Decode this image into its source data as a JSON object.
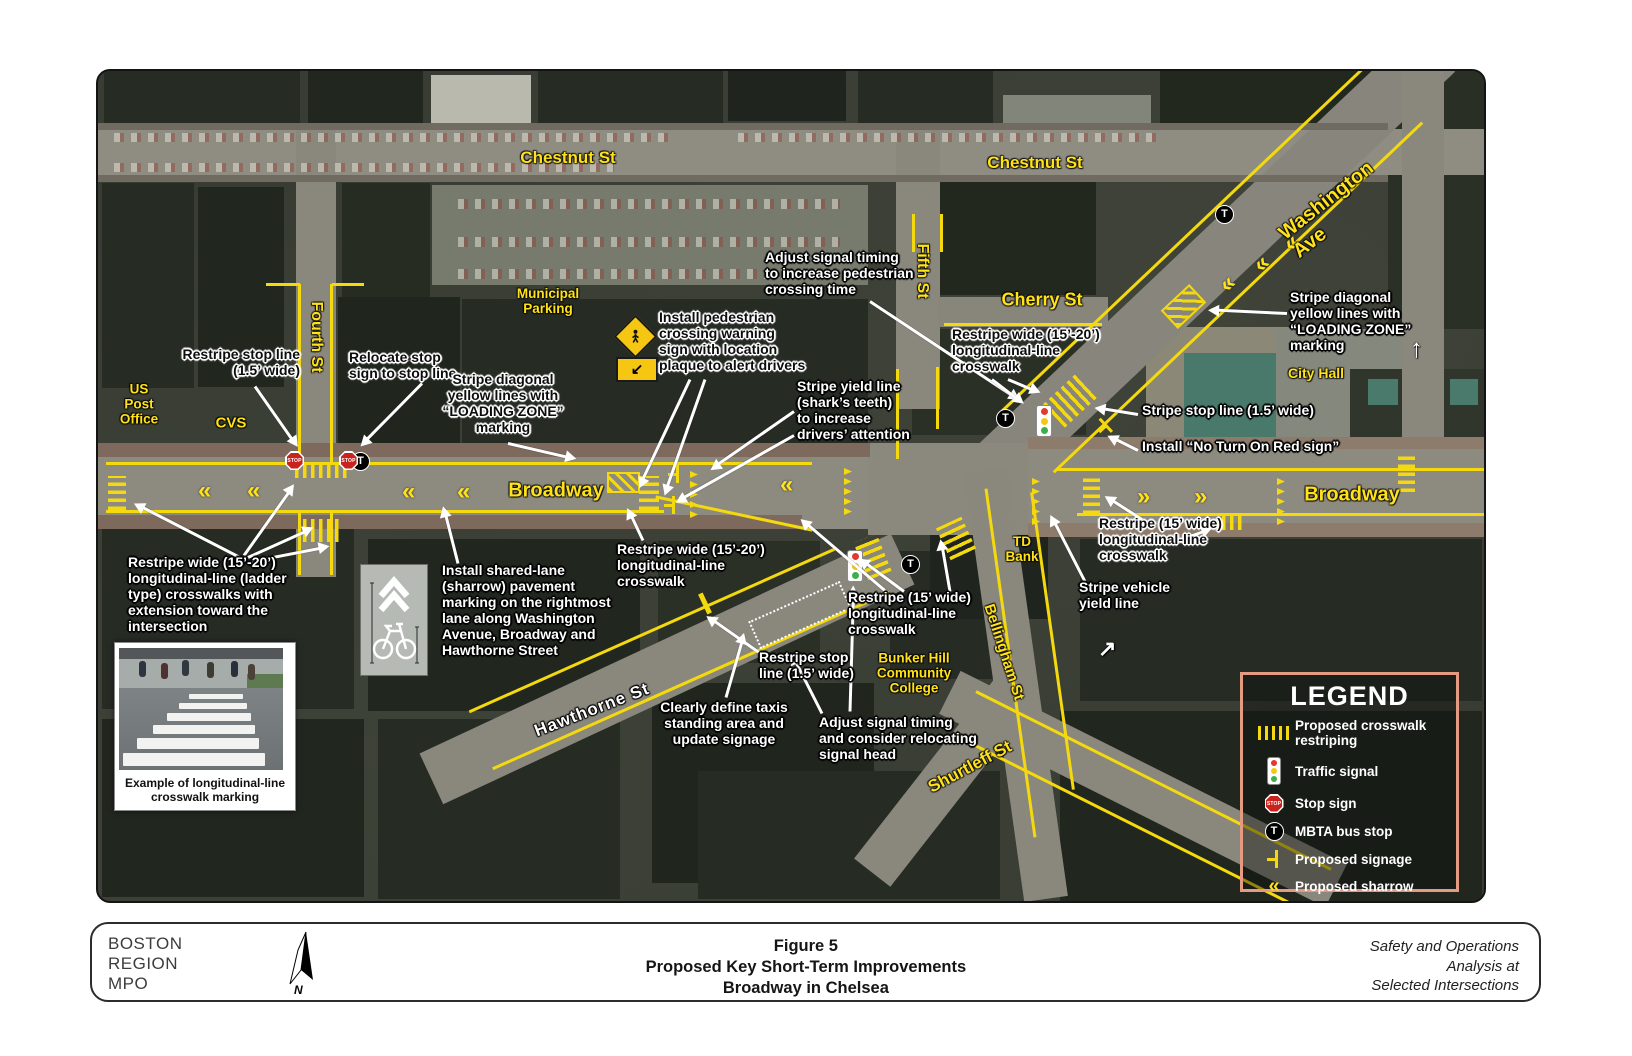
{
  "map": {
    "streets": {
      "chestnut_west": "Chestnut St",
      "chestnut_east": "Chestnut St",
      "fourth": "Fourth St",
      "fifth": "Fifth St",
      "cherry": "Cherry St",
      "washington": "Washington Ave",
      "broadway_west": "Broadway",
      "broadway_east": "Broadway",
      "hawthorne": "Hawthorne St",
      "bellingham": "Bellingham St",
      "shurtleff": "Shurtleff St"
    },
    "places": {
      "municipal_parking": "Municipal\nParking",
      "us_post_office": "US\nPost\nOffice",
      "cvs": "CVS",
      "city_hall": "City Hall",
      "td_bank": "TD\nBank",
      "bunker_hill": "Bunker Hill\nCommunity\nCollege"
    },
    "callouts": {
      "restripe_stop_nw": "Restripe stop line\n(1.5’ wide)",
      "relocate_stop": "Relocate stop\nsign to stop line",
      "loading_zone_w": "Stripe diagonal\nyellow lines with\n“LOADING ZONE”\nmarking",
      "ped_sign": "Install pedestrian\ncrossing warning\nsign with location\nplaque to alert drivers",
      "adjust_signal_n": "Adjust signal timing\nto increase pedestrian\ncrossing time",
      "yield_line": "Stripe yield line\n(shark’s teeth)\nto increase\ndrivers’ attention",
      "restripe_cherry": "Restripe wide (15’-20’)\nlongitudinal-line\ncrosswalk",
      "loading_zone_e": "Stripe diagonal\nyellow lines with\n“LOADING ZONE”\nmarking",
      "stop_line_e": "Stripe stop line (1.5’ wide)",
      "no_turn_red": "Install “No Turn On Red sign”",
      "restripe_15_e": "Restripe (15’ wide)\nlongitudinal-line\ncrosswalk",
      "vehicle_yield": "Stripe vehicle\nyield line",
      "restripe_15_c": "Restripe (15’ wide)\nlongitudinal-line\ncrosswalk",
      "ladder": "Restripe wide (15’-20’)\nlongitudinal-line (ladder\ntype) crosswalks with\nextension toward the\nintersection",
      "sharrow_note": "Install shared-lane\n(sharrow) pavement\nmarking on the rightmost\nlane along Washington\nAvenue, Broadway and\nHawthorne Street",
      "restripe_wide_c": "Restripe wide (15’-20’)\nlongitudinal-line\ncrosswalk",
      "restripe_stop_s": "Restripe stop\nline (1.5’ wide)",
      "taxi": "Clearly define taxis\nstanding area and\nupdate signage",
      "adjust_signal_s": "Adjust signal timing\nand consider relocating\nsignal head"
    },
    "inset_photo_caption": "Example of longitudinal-line\ncrosswalk marking"
  },
  "legend": {
    "title": "LEGEND",
    "items": [
      {
        "icon": "crosswalk-restriping-icon",
        "label": "Proposed crosswalk restriping"
      },
      {
        "icon": "traffic-signal-icon",
        "label": "Traffic signal"
      },
      {
        "icon": "stop-sign-icon",
        "label": "Stop sign"
      },
      {
        "icon": "mbta-bus-stop-icon",
        "label": "MBTA bus stop"
      },
      {
        "icon": "proposed-signage-icon",
        "label": "Proposed signage"
      },
      {
        "icon": "proposed-sharrow-icon",
        "label": "Proposed sharrow"
      }
    ]
  },
  "icons": {
    "mbta": "T",
    "stop": "STOP",
    "sharrow_left": "«",
    "sharrow_right": "»",
    "up_arrow": "↑",
    "ne_arrow": "↗",
    "diag_arrow": "↙"
  },
  "colors": {
    "marking_yellow": "#f4d90e",
    "label_yellow": "#ffe219",
    "legend_border": "#e59a82",
    "stop_red": "#c9231d"
  },
  "footer": {
    "org": "BOSTON\nREGION\nMPO",
    "title": "Figure 5\nProposed Key Short-Term Improvements\nBroadway in Chelsea",
    "right": "Safety and Operations\nAnalysis at\nSelected Intersections"
  }
}
